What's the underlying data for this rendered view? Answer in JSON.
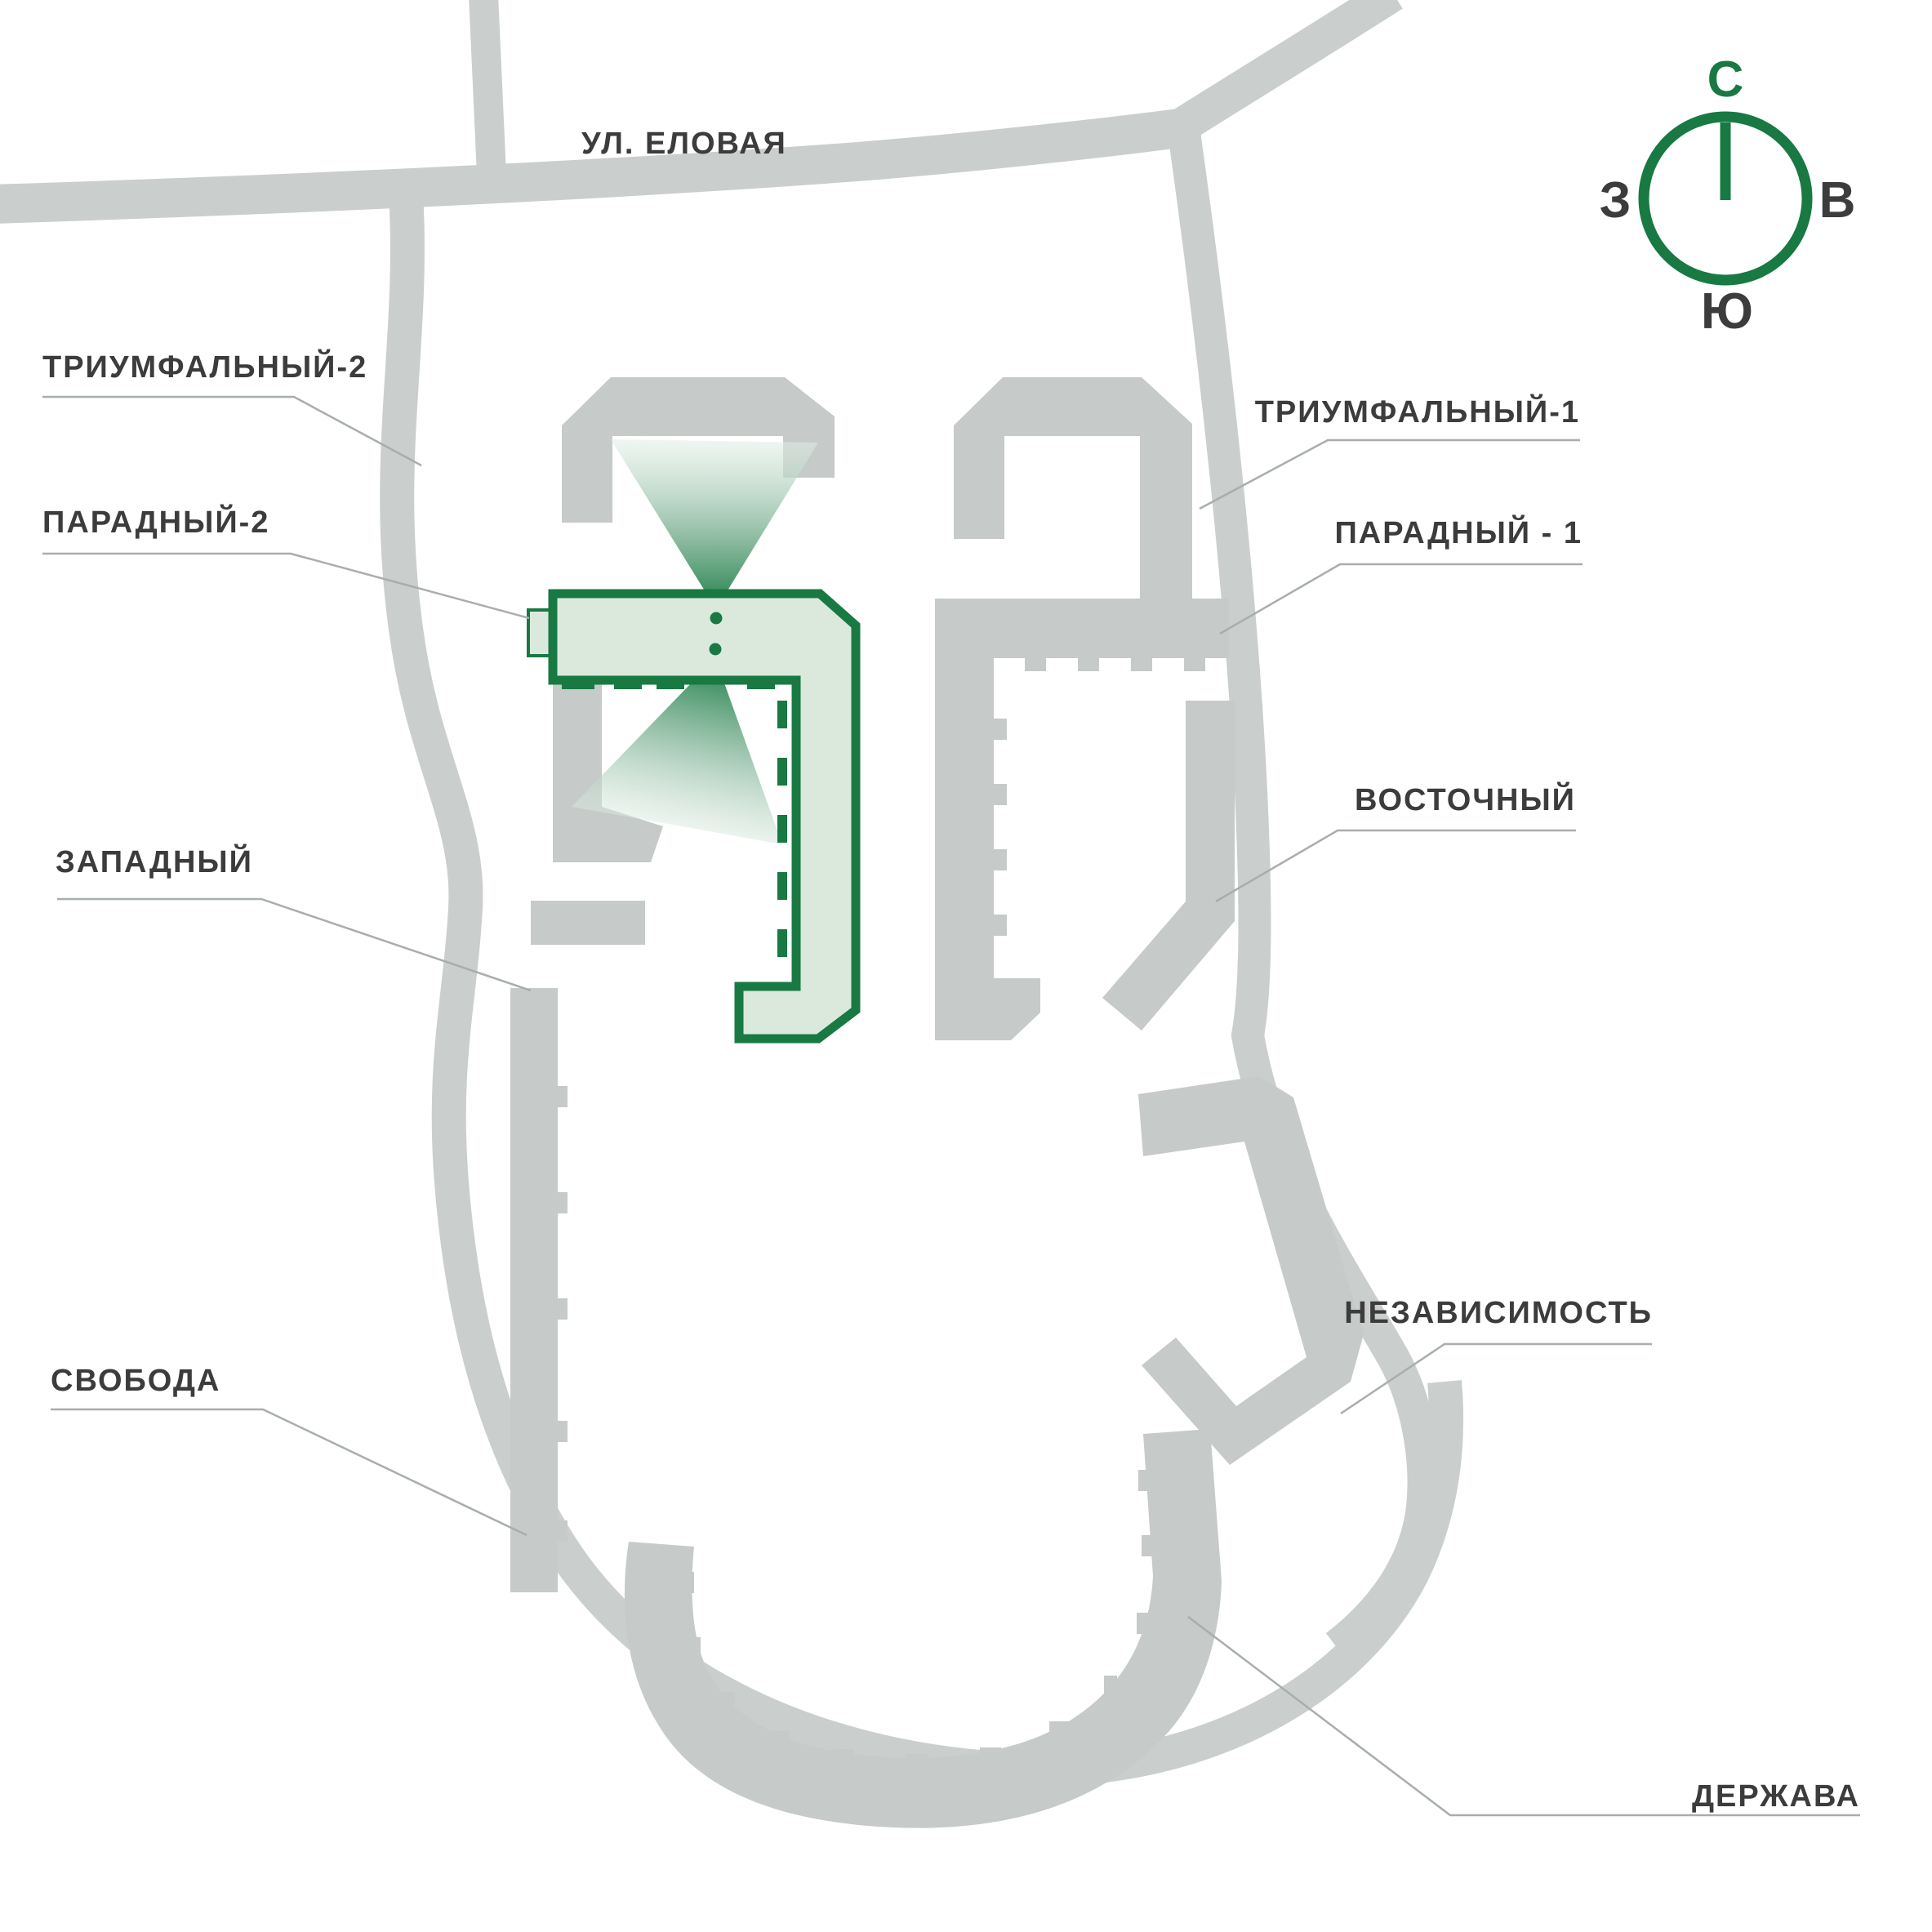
{
  "labels": {
    "street": "УЛ. ЕЛОВАЯ",
    "triumfalny2": "ТРИУМФАЛЬНЫЙ-2",
    "paradny2": "ПАРАДНЫЙ-2",
    "zapadny": "ЗАПАДНЫЙ",
    "svoboda": "СВОБОДА",
    "triumfalny1": "ТРИУМФАЛЬНЫЙ-1",
    "paradny1": "ПАРАДНЫЙ - 1",
    "vostochny": "ВОСТОЧНЫЙ",
    "nezavisimost": "НЕЗАВИСИМОСТЬ",
    "derzhava": "ДЕРЖАВА"
  },
  "compass": {
    "north": "С",
    "east": "В",
    "south": "Ю",
    "west": "З"
  },
  "colors": {
    "accent_green": "#187943",
    "selection_fill": "#dbe9dc",
    "road": "#cacecd",
    "building": "#c6cac9",
    "leader": "#a8adad",
    "text": "#3c3c3c"
  }
}
